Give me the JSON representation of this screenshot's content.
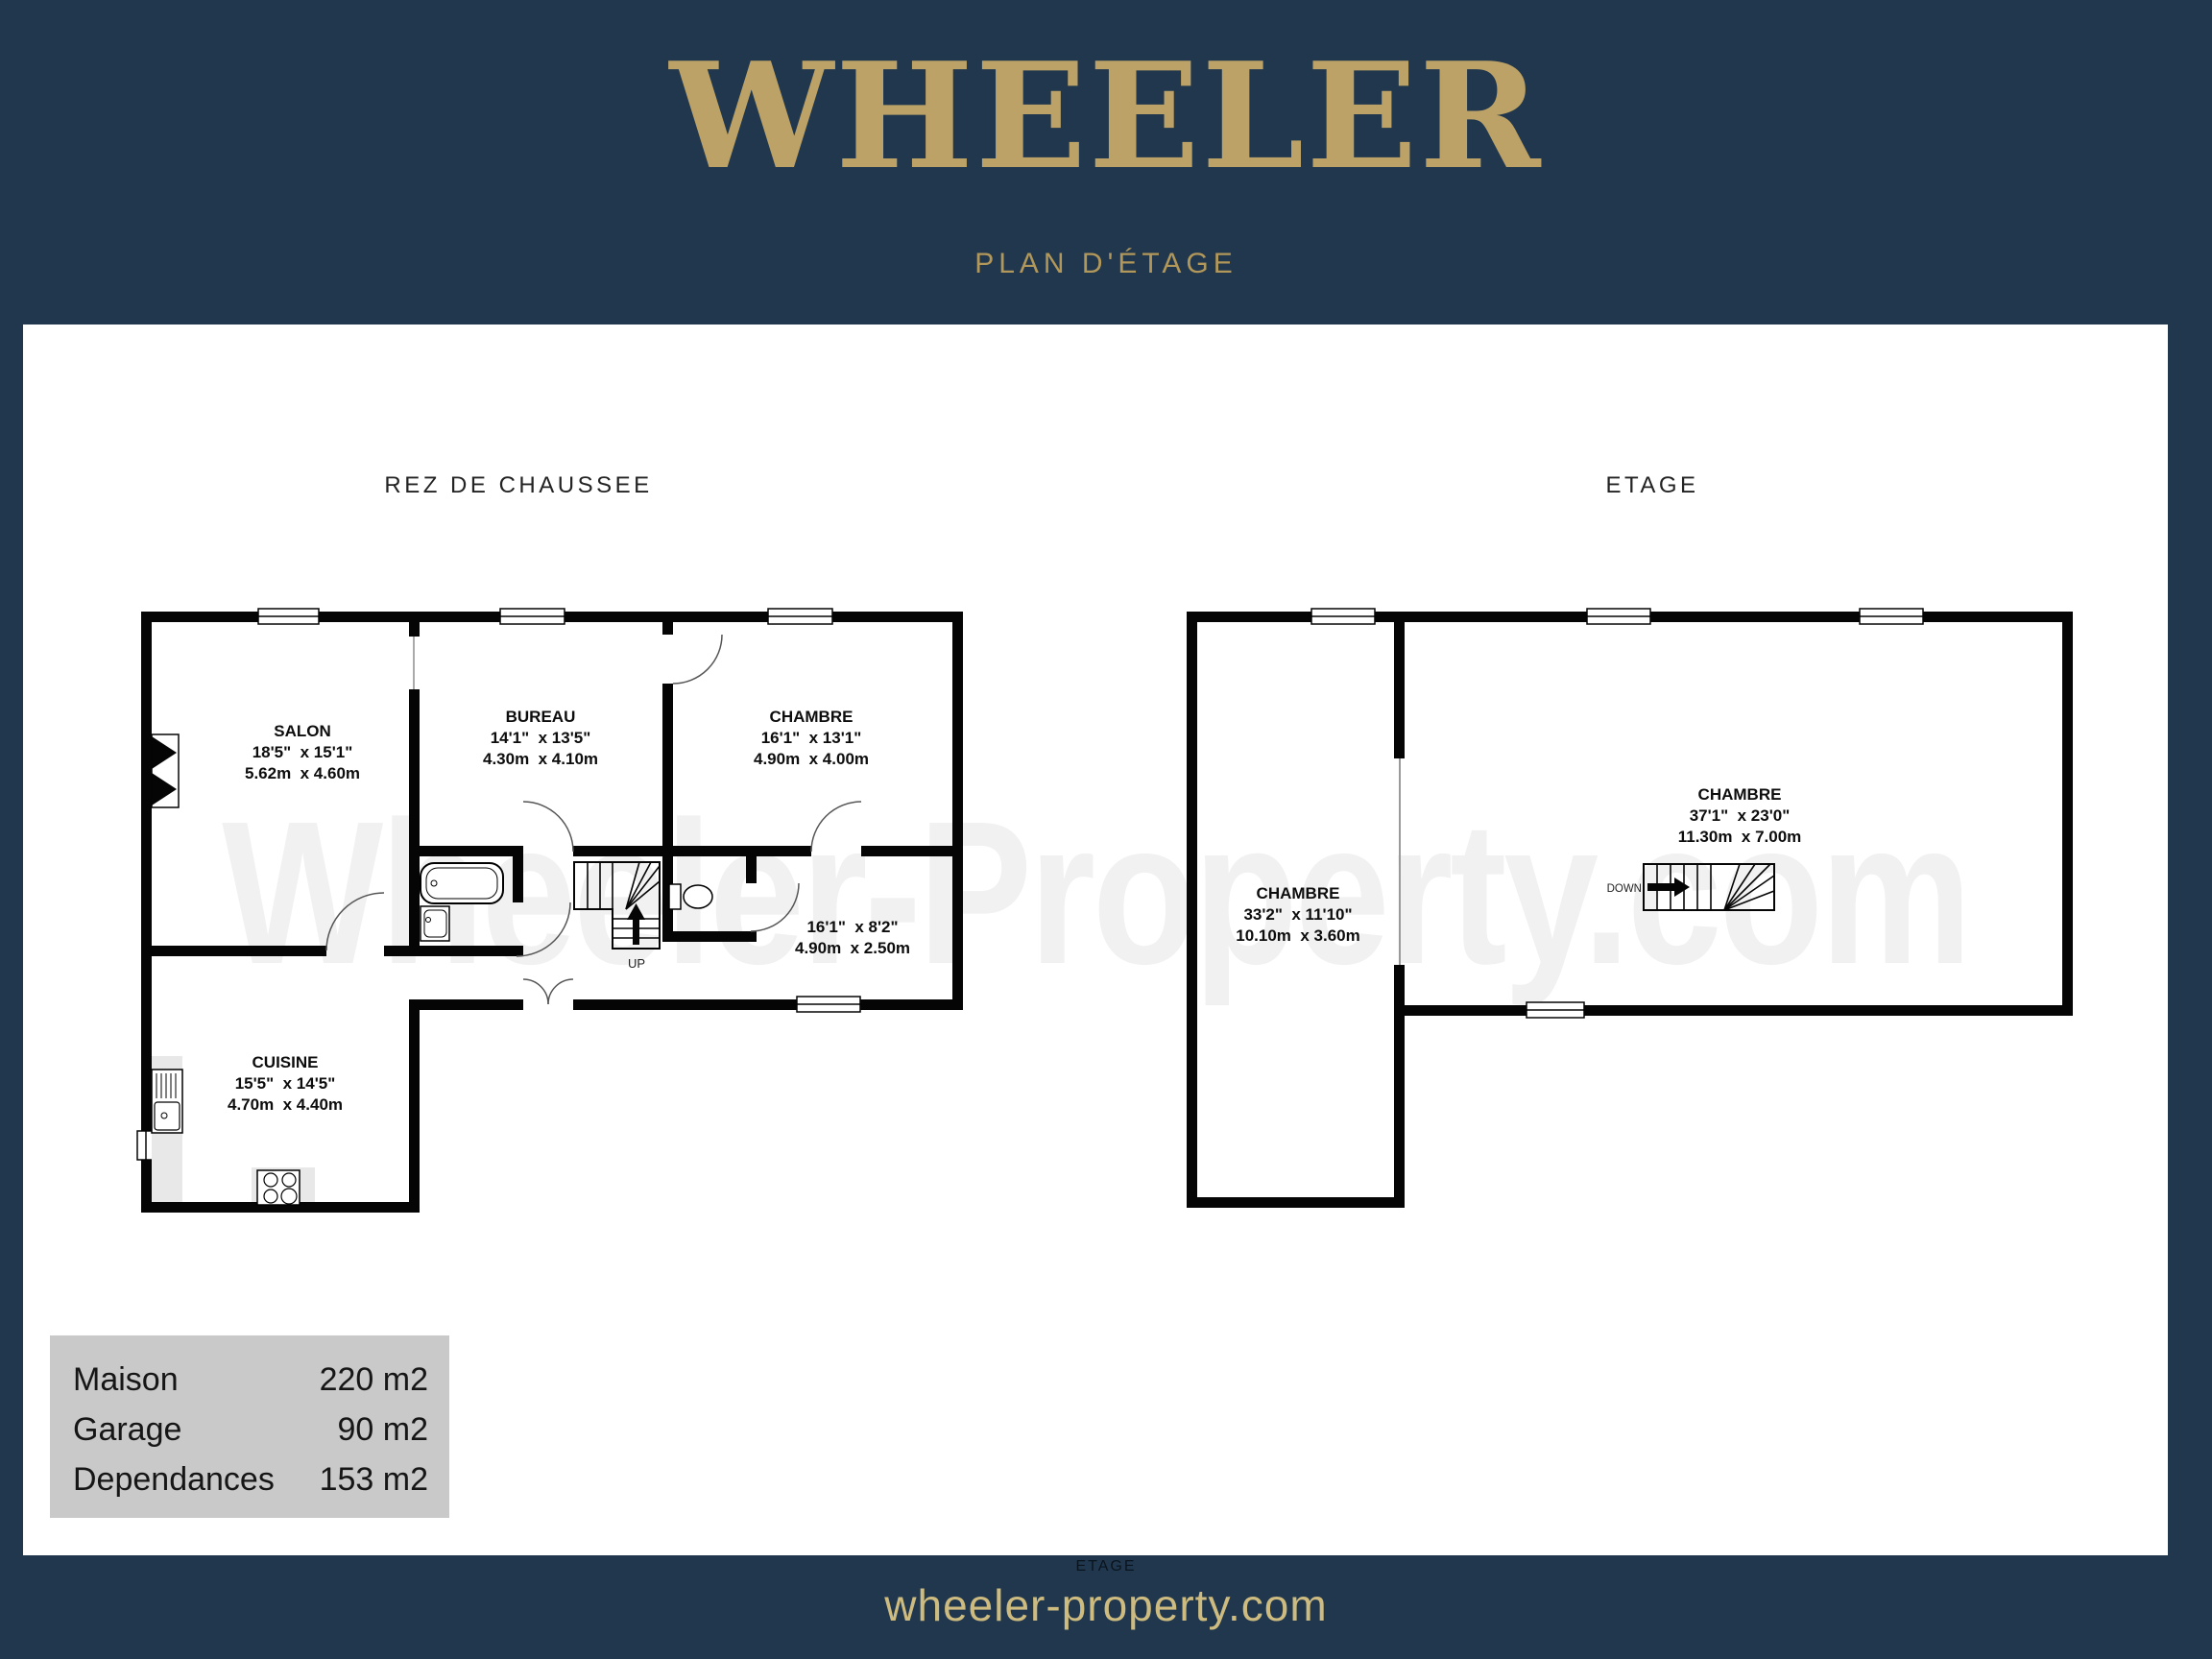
{
  "brand": {
    "name": "WHEELER",
    "tagline": "PLAN D'ÉTAGE"
  },
  "watermark": "Wheeler-Property.com",
  "footer": {
    "website": "wheeler-property.com",
    "caption": "ETAGE"
  },
  "plans": [
    {
      "title": "REZ DE CHAUSSEE",
      "stair_label": "UP",
      "rooms": [
        {
          "name": "SALON",
          "imperial": "18'5\"  x 15'1\"",
          "metric": "5.62m  x 4.60m"
        },
        {
          "name": "BUREAU",
          "imperial": "14'1\"  x 13'5\"",
          "metric": "4.30m  x 4.10m"
        },
        {
          "name": "CHAMBRE",
          "imperial": "16'1\"  x 13'1\"",
          "metric": "4.90m  x 4.00m"
        },
        {
          "name": "",
          "imperial": "16'1\"  x 8'2\"",
          "metric": "4.90m  x 2.50m"
        },
        {
          "name": "CUISINE",
          "imperial": "15'5\"  x 14'5\"",
          "metric": "4.70m  x 4.40m"
        }
      ]
    },
    {
      "title": "ETAGE",
      "stair_label": "DOWN",
      "rooms": [
        {
          "name": "CHAMBRE",
          "imperial": "33'2\"  x 11'10\"",
          "metric": "10.10m  x 3.60m"
        },
        {
          "name": "CHAMBRE",
          "imperial": "37'1\"  x 23'0\"",
          "metric": "11.30m  x 7.00m"
        }
      ]
    }
  ],
  "summary": {
    "rows": [
      {
        "label": "Maison",
        "value": "220 m2"
      },
      {
        "label": "Garage",
        "value": "90 m2"
      },
      {
        "label": "Dependances",
        "value": "153 m2"
      }
    ]
  },
  "colors": {
    "navy": "#20374d",
    "gold_title": "#bca266",
    "gold_tagline": "#b2975a",
    "gold_footer": "#cdbb80",
    "wall": "#050505",
    "summary_bg": "#c9c9c9",
    "watermark": "#f1f1f1"
  }
}
